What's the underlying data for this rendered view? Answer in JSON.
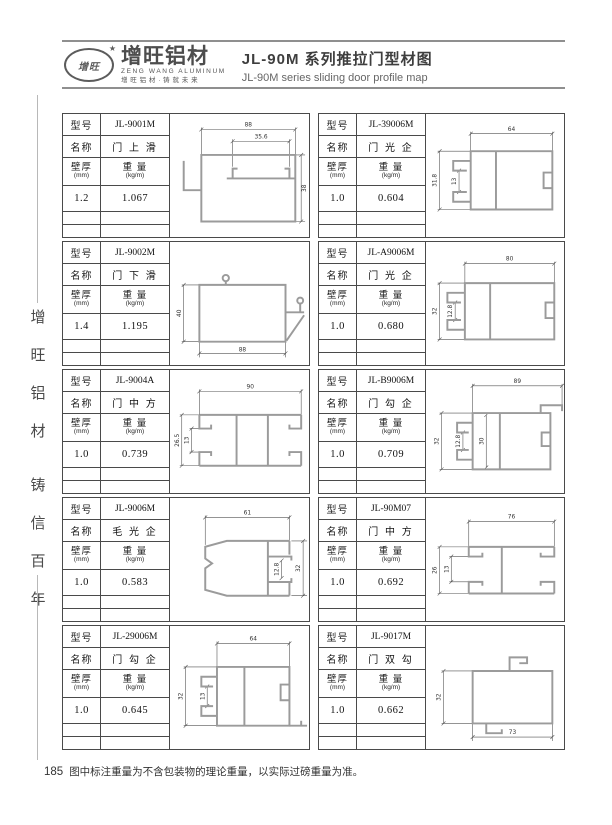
{
  "header": {
    "logo": {
      "oval_text": "增旺",
      "star": "★",
      "brand_cn": "增旺铝材",
      "brand_en": "ZENG WANG ALUMINUM",
      "slogan": "增旺铝材·铸就未来"
    },
    "title_cn": "JL-90M 系列推拉门型材图",
    "title_en": "JL-90M series sliding door profile map"
  },
  "sidebar": {
    "chars": [
      "增",
      "旺",
      "铝",
      "材",
      "铸",
      "信",
      "百",
      "年"
    ]
  },
  "labels": {
    "model": "型号",
    "name": "名称",
    "thickness": "壁厚",
    "thickness_unit": "(mm)",
    "weight": "重 量",
    "weight_unit": "(kg/m)"
  },
  "cells": [
    {
      "model": "JL-9001M",
      "name": "门 上 滑",
      "thickness": "1.2",
      "weight": "1.067",
      "dims": {
        "w": "88",
        "w2": "35.6",
        "h": "38"
      }
    },
    {
      "model": "JL-39006M",
      "name": "门 光 企",
      "thickness": "1.0",
      "weight": "0.604",
      "dims": {
        "w": "64",
        "h": "31.8",
        "slot": "13"
      }
    },
    {
      "model": "JL-9002M",
      "name": "门 下 滑",
      "thickness": "1.4",
      "weight": "1.195",
      "dims": {
        "w": "88",
        "h": "40"
      }
    },
    {
      "model": "JL-A9006M",
      "name": "门 光 企",
      "thickness": "1.0",
      "weight": "0.680",
      "dims": {
        "w": "80",
        "h": "32",
        "slot": "12.8"
      }
    },
    {
      "model": "JL-9004A",
      "name": "门 中 方",
      "thickness": "1.0",
      "weight": "0.739",
      "dims": {
        "w": "90",
        "h": "26.5",
        "slot": "13"
      }
    },
    {
      "model": "JL-B9006M",
      "name": "门 勾 企",
      "thickness": "1.0",
      "weight": "0.709",
      "dims": {
        "w": "89",
        "h": "32",
        "slot": "12.8",
        "inner": "30"
      }
    },
    {
      "model": "JL-9006M",
      "name": "毛 光 企",
      "thickness": "1.0",
      "weight": "0.583",
      "dims": {
        "w": "61",
        "h": "32",
        "slot": "12.8"
      }
    },
    {
      "model": "JL-90M07",
      "name": "门 中 方",
      "thickness": "1.0",
      "weight": "0.692",
      "dims": {
        "w": "76",
        "h": "26",
        "slot": "13"
      }
    },
    {
      "model": "JL-29006M",
      "name": "门 勾 企",
      "thickness": "1.0",
      "weight": "0.645",
      "dims": {
        "w": "64",
        "h": "32",
        "slot": "13"
      }
    },
    {
      "model": "JL-9017M",
      "name": "门 双 勾",
      "thickness": "1.0",
      "weight": "0.662",
      "dims": {
        "w": "73",
        "h": "32"
      }
    }
  ],
  "footer": {
    "page": "185",
    "note": "图中标注重量为不含包装物的理论重量，以实际过磅重量为准。"
  }
}
